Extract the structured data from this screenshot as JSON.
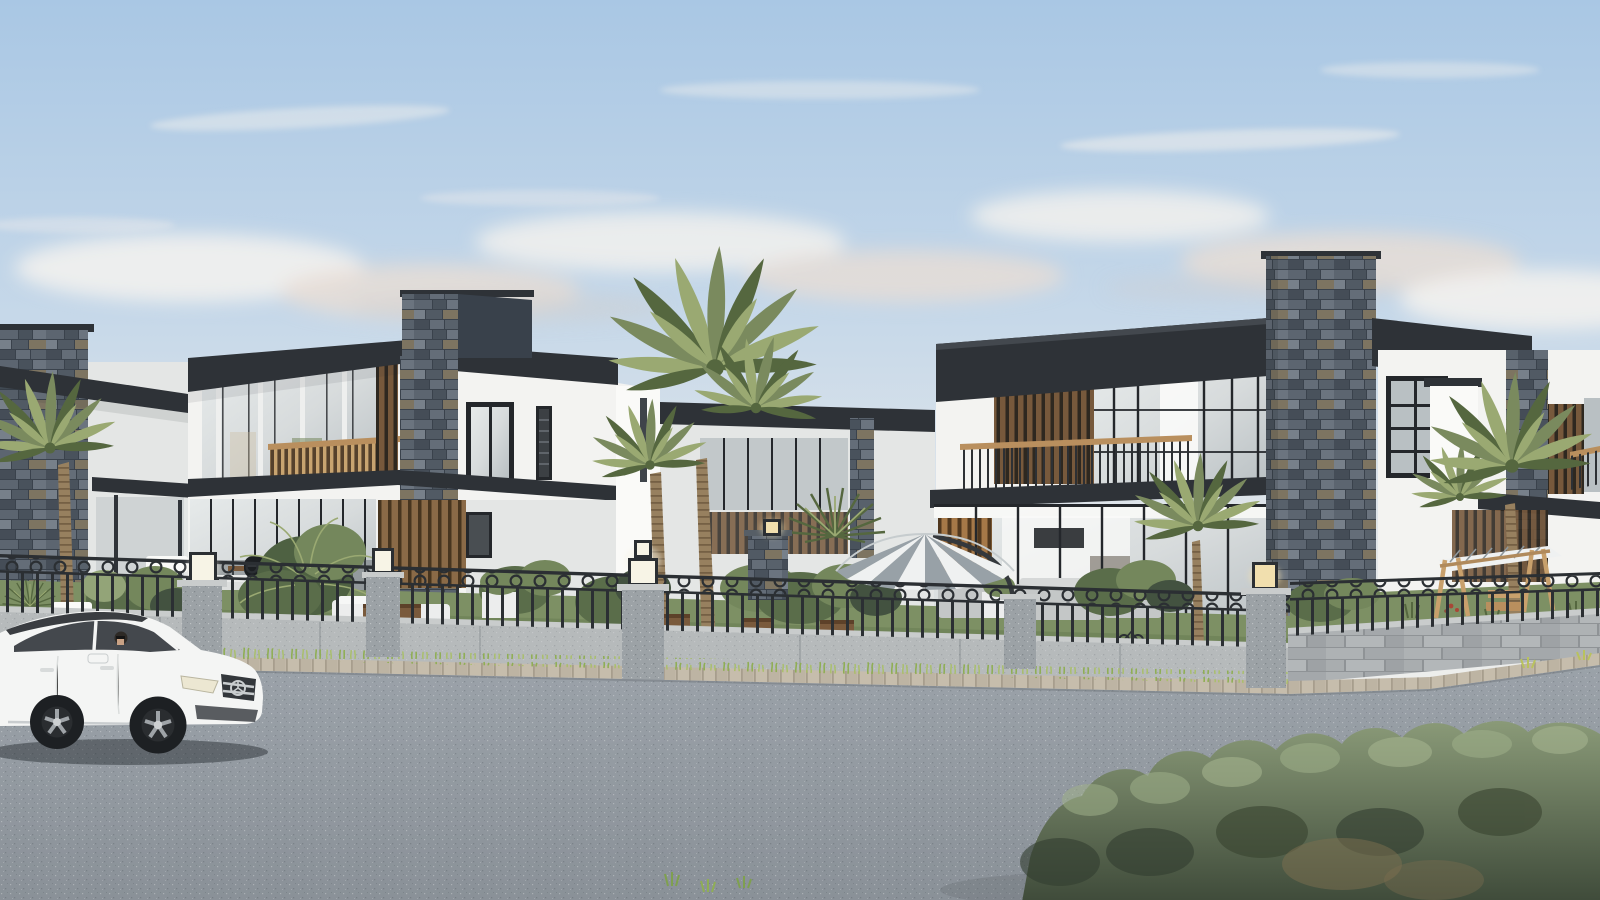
{
  "scene": {
    "type": "architectural-exterior-render",
    "setting": "modern-villa-complex-street-view",
    "objects": [
      {
        "name": "sky",
        "label": "pale blue sky with soft clouds"
      },
      {
        "name": "villa-far-left",
        "label": "partial white villa with stone tower and carport"
      },
      {
        "name": "villa-left",
        "label": "two-storey white villa, dark flat roof, stone tower, wood slats, balcony"
      },
      {
        "name": "villa-center-rear",
        "label": "background villa behind palm trees"
      },
      {
        "name": "villa-right",
        "label": "two-storey white villa, glass facade, wood slat screen, tall stone tower"
      },
      {
        "name": "villa-far-right",
        "label": "partial white villa with window grid, stone strip and wood slats"
      },
      {
        "name": "palm-tree-left",
        "label": "fan palm at far left"
      },
      {
        "name": "palm-trees-center",
        "label": "tall twin fan palms in front garden"
      },
      {
        "name": "palm-tree-mid-right",
        "label": "palm in front of right villa"
      },
      {
        "name": "palm-tree-far-right",
        "label": "palm beside far-right villa"
      },
      {
        "name": "cycad-plant",
        "label": "cycad in center garden"
      },
      {
        "name": "garden-shrubs",
        "label": "assorted hedges and shrubs behind fence"
      },
      {
        "name": "patio-sofas-left",
        "label": "white wicker outdoor sofa set"
      },
      {
        "name": "patio-sofas-right",
        "label": "gray outdoor sofa set"
      },
      {
        "name": "bbq-grill",
        "label": "black barrel barbecue on wood cart"
      },
      {
        "name": "cantilever-umbrella",
        "label": "white and gray striped cantilever parasol"
      },
      {
        "name": "wooden-swing",
        "label": "wooden swing bench with striped canopy"
      },
      {
        "name": "perimeter-wall",
        "label": "concrete plinth wall with paver curb"
      },
      {
        "name": "metal-fence",
        "label": "black railing fence with circle motif"
      },
      {
        "name": "fence-pillars",
        "label": "granite pillars with cube lanterns"
      },
      {
        "name": "gate-pillar",
        "label": "stone gate pillar with warm lantern"
      },
      {
        "name": "asphalt-road",
        "label": "gray asphalt street"
      },
      {
        "name": "white-suv",
        "label": "white luxury SUV with driver"
      },
      {
        "name": "corner-bush",
        "label": "large shrub mass in bottom right corner"
      }
    ],
    "lamp_states": {
      "white_lanterns": "lit",
      "warm_lanterns": "lit"
    }
  },
  "palette": {
    "skyTop": "#a9c7e4",
    "skyMid": "#c6d8e9",
    "skyLow": "#e3e7ea",
    "skyHorizon": "#efefed",
    "cloud": "#f5f2ee",
    "cloudWarm": "#e9ddd4",
    "cloudGray": "#cfcfd0",
    "roof": "#2e3237",
    "roofEdge": "#43484e",
    "white": "#f3f3f1",
    "whiteSh": "#e4e6e5",
    "whiteBr": "#fafaf8",
    "glass": "#d7dbdc",
    "glassD": "#b9c0c3",
    "mullion": "#24272b",
    "frameW": "#eeefee",
    "railWood": "#b98f5e",
    "fence": "#2b2f33",
    "lawn": "#7d9064",
    "lawnD": "#66794f",
    "bushA": "#5a6d4a",
    "bushB": "#74875c",
    "bushC": "#93a478",
    "bushD": "#435240",
    "fern": "#4e6142",
    "palmGreen": "#7a8a5e",
    "palmLight": "#9aa972",
    "palmDark": "#55673f",
    "trunk": "#97805f",
    "trunkDark": "#6f5a40",
    "concrete": "#b6babb",
    "concCap": "#c9cccc",
    "concreteB": "#aeb2b4",
    "concJoint": "#9da2a4",
    "granite": "#9ca2a6",
    "paver": "#c6bdac",
    "paverJoint": "#a79e8d",
    "asphalt": "#9ba2a9",
    "asphaltDark": "#8a9198",
    "carWhite": "#f4f5f4",
    "carShade": "#dce0e1",
    "carGlass": "#44484d",
    "carDark": "#26292d",
    "chrome": "#c9cdcf",
    "headlight": "#ece7d2",
    "lampWhite": "#f7f4e6",
    "lampWarm": "#f1dfae",
    "umbrellaWhite": "#eff1f1",
    "umbrellaGray": "#98a1a7",
    "sofaGray": "#c4c7c7",
    "sofaWhite": "#eceded",
    "artFrame": "#3a3d40",
    "interiorWarm": "#caba9c",
    "weed": "#b9c25e"
  }
}
